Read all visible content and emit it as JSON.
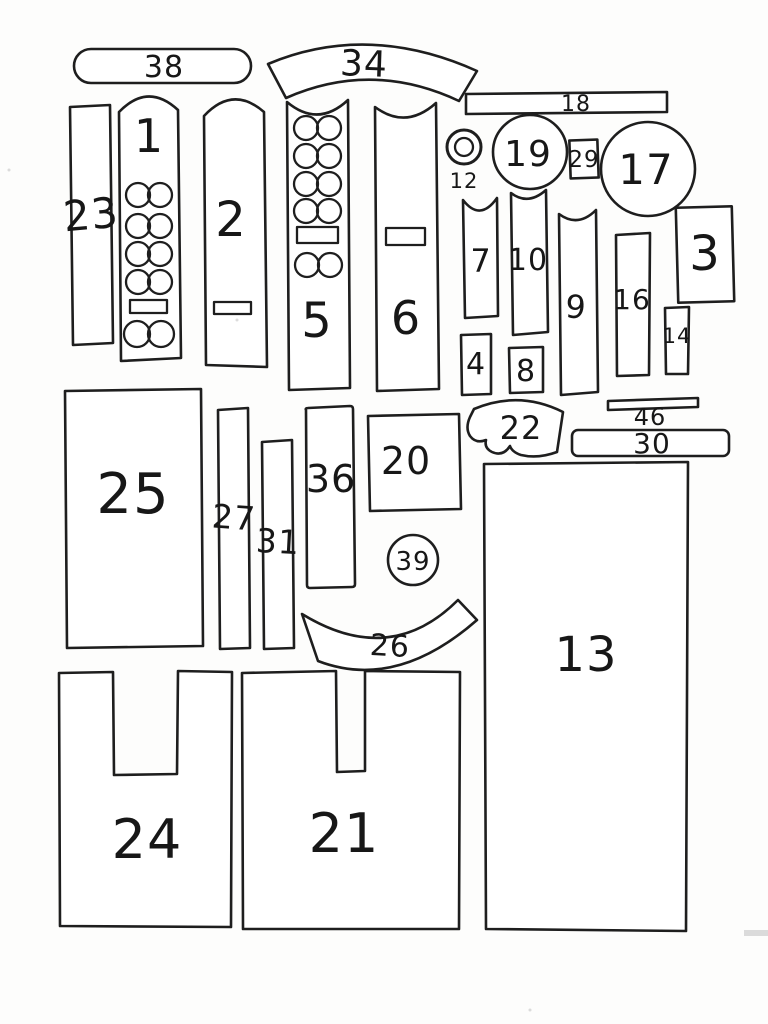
{
  "paper_color": "#fdfdfc",
  "ink_color": "#1e1e1e",
  "labels": {
    "p1": "1",
    "p2": "2",
    "p3": "3",
    "p4": "4",
    "p5": "5",
    "p6": "6",
    "p7": "7",
    "p8": "8",
    "p9": "9",
    "p10": "10",
    "p12": "12",
    "p13": "13",
    "p14": "14",
    "p16": "16",
    "p17": "17",
    "p18": "18",
    "p19": "19",
    "p20": "20",
    "p21": "21",
    "p22": "22",
    "p23": "23",
    "p24": "24",
    "p25": "25",
    "p26": "26",
    "p27": "27",
    "p29": "29",
    "p30": "30",
    "p31": "31",
    "p34": "34",
    "p36": "36",
    "p38": "38",
    "p39": "39",
    "p46": "46"
  }
}
